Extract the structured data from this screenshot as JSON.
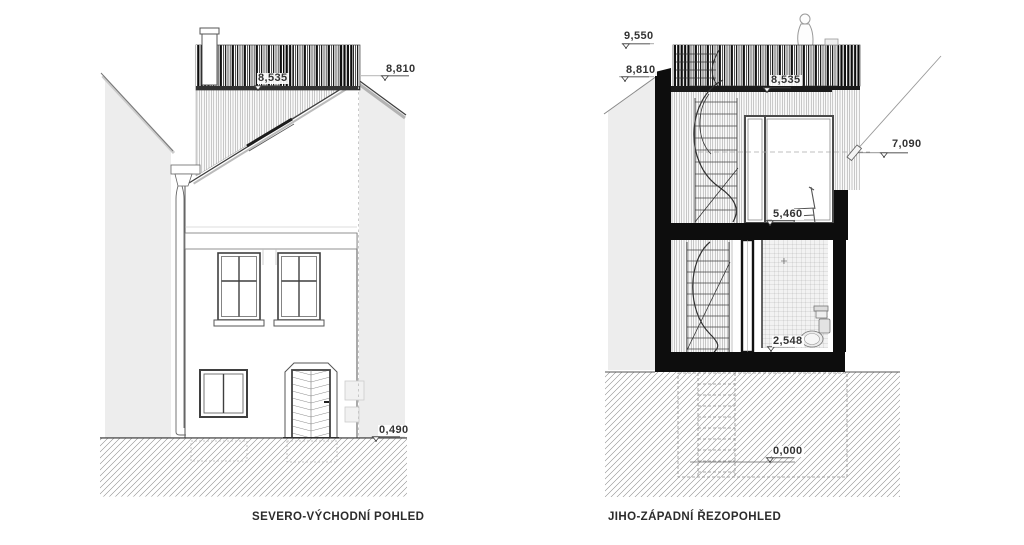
{
  "sheet": {
    "type": "architectural elevation and section drawings"
  },
  "drawings": {
    "left": {
      "caption": "SEVERO-VÝCHODNÍ POHLED",
      "levels": {
        "railing": "8,535",
        "ridge": "8,810",
        "plinth": "0,490"
      }
    },
    "right": {
      "caption": "JIHO-ZÁPADNÍ ŘEZOPOHLED",
      "levels": {
        "railing_top": "9,550",
        "roof_edge": "8,810",
        "terrace_floor": "8,535",
        "eaves": "7,090",
        "upper_floor": "5,460",
        "ground_floor": "2,548",
        "base": "0,000"
      }
    }
  },
  "colors": {
    "background": "#ffffff",
    "line": "#3c3c3c",
    "cut_fill": "#0d0d0d",
    "neighbor_gray": "#ededed",
    "hatch_line": "#8a8a8a",
    "label_text": "#333333"
  }
}
